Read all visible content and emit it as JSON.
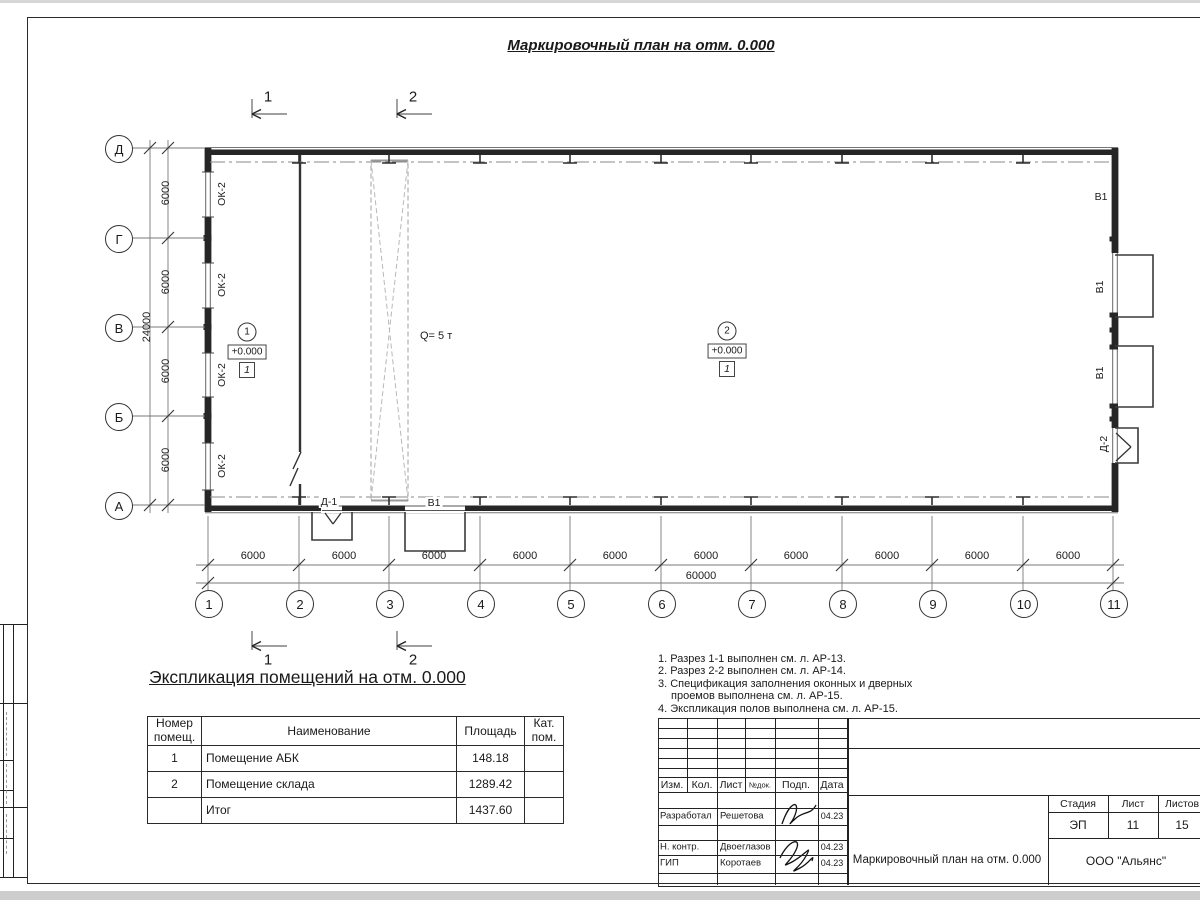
{
  "sheet_title": "Маркировочный план на отм. 0.000",
  "plan": {
    "row_axes": [
      "Д",
      "Г",
      "В",
      "Б",
      "А"
    ],
    "col_axes": [
      "1",
      "2",
      "3",
      "4",
      "5",
      "6",
      "7",
      "8",
      "9",
      "10",
      "11"
    ],
    "section_marks": {
      "s1": "1",
      "s2": "2"
    },
    "dims": {
      "span": "6000",
      "total_h": "60000",
      "total_v": "24000"
    },
    "labels": {
      "window": "ОК-2",
      "gate": "В1",
      "door1": "Д-1",
      "door2": "Д-2",
      "crane": "Q= 5 т",
      "elevation": "+0.000",
      "floor_type": "1",
      "room1": "1",
      "room2": "2"
    }
  },
  "explication": {
    "heading": "Экспликация помещений на отм. 0.000",
    "columns": [
      "Номер помещ.",
      "Наименование",
      "Площадь",
      "Кат. пом."
    ],
    "rows": [
      {
        "num": "1",
        "name": "Помещение АБК",
        "area": "148.18",
        "cat": ""
      },
      {
        "num": "2",
        "name": "Помещение склада",
        "area": "1289.42",
        "cat": ""
      },
      {
        "num": "",
        "name": "Итог",
        "area": "1437.60",
        "cat": ""
      }
    ]
  },
  "notes": {
    "lines": [
      "1. Разрез 1-1 выполнен см. л. АР-13.",
      "2. Разрез 2-2 выполнен см. л. АР-14.",
      "3. Спецификация заполнения оконных и дверных",
      "проемов выполнена см. л. АР-15.",
      "4. Экспликация полов выполнена см. л. АР-15."
    ]
  },
  "titleblock": {
    "headers": {
      "izm": "Изм.",
      "kol": "Кол.",
      "list": "Лист",
      "ndok": "№док.",
      "podp": "Подп.",
      "data": "Дата"
    },
    "rows": [
      {
        "role": "Разработал",
        "name": "Решетова",
        "date": "04.23"
      },
      {
        "role": "Н. контр.",
        "name": "Двоеглазов",
        "date": "04.23"
      },
      {
        "role": "ГИП",
        "name": "Коротаев",
        "date": "04.23"
      }
    ],
    "doc_title": "Маркировочный план на отм. 0.000",
    "org": "ООО \"Альянс\"",
    "stage_label": "Стадия",
    "sheet_label": "Лист",
    "sheets_label": "Листов",
    "stage": "ЭП",
    "sheet": "11",
    "sheets": "15"
  }
}
